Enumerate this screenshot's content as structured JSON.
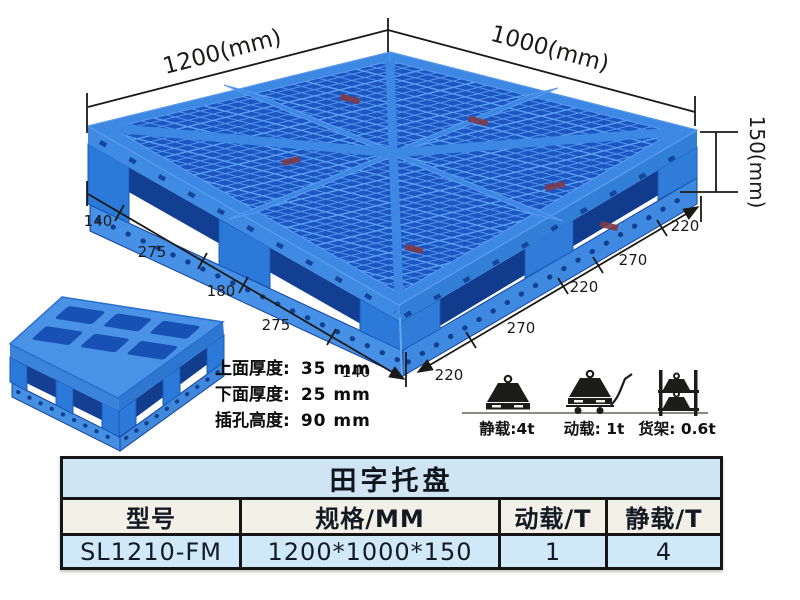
{
  "colors": {
    "pallet_blue": "#3c87e2",
    "pallet_rib_blue": "#5096ec",
    "pallet_hole_blue": "#1d55c2",
    "table_title_bg": "#cfe5f3",
    "table_header_bg": "#f3f0e7",
    "table_data_bg": "#cfe9f8",
    "page_background": "#faf7ea"
  },
  "dimensions": {
    "length": "1200(mm)",
    "width": "1000(mm)",
    "height": "150(mm)",
    "left_chain": [
      "140",
      "275",
      "180",
      "275",
      "140"
    ],
    "right_chain": [
      "220",
      "270",
      "220",
      "270",
      "220"
    ]
  },
  "thickness_notes": {
    "items": [
      {
        "label": "上面厚度:",
        "value": "35 mm"
      },
      {
        "label": "下面厚度:",
        "value": "25 mm"
      },
      {
        "label": "插孔高度:",
        "value": "90 mm"
      }
    ]
  },
  "load_ratings": {
    "static_label": "静载:4t",
    "dynamic_label": "动载: 1t",
    "rack_label": "货架: 0.6t"
  },
  "table": {
    "title": "田字托盘",
    "headers": [
      "型号",
      "规格/MM",
      "动载/T",
      "静载/T"
    ],
    "rows": [
      [
        "SL1210-FM",
        "1200*1000*150",
        "1",
        "4"
      ]
    ]
  }
}
